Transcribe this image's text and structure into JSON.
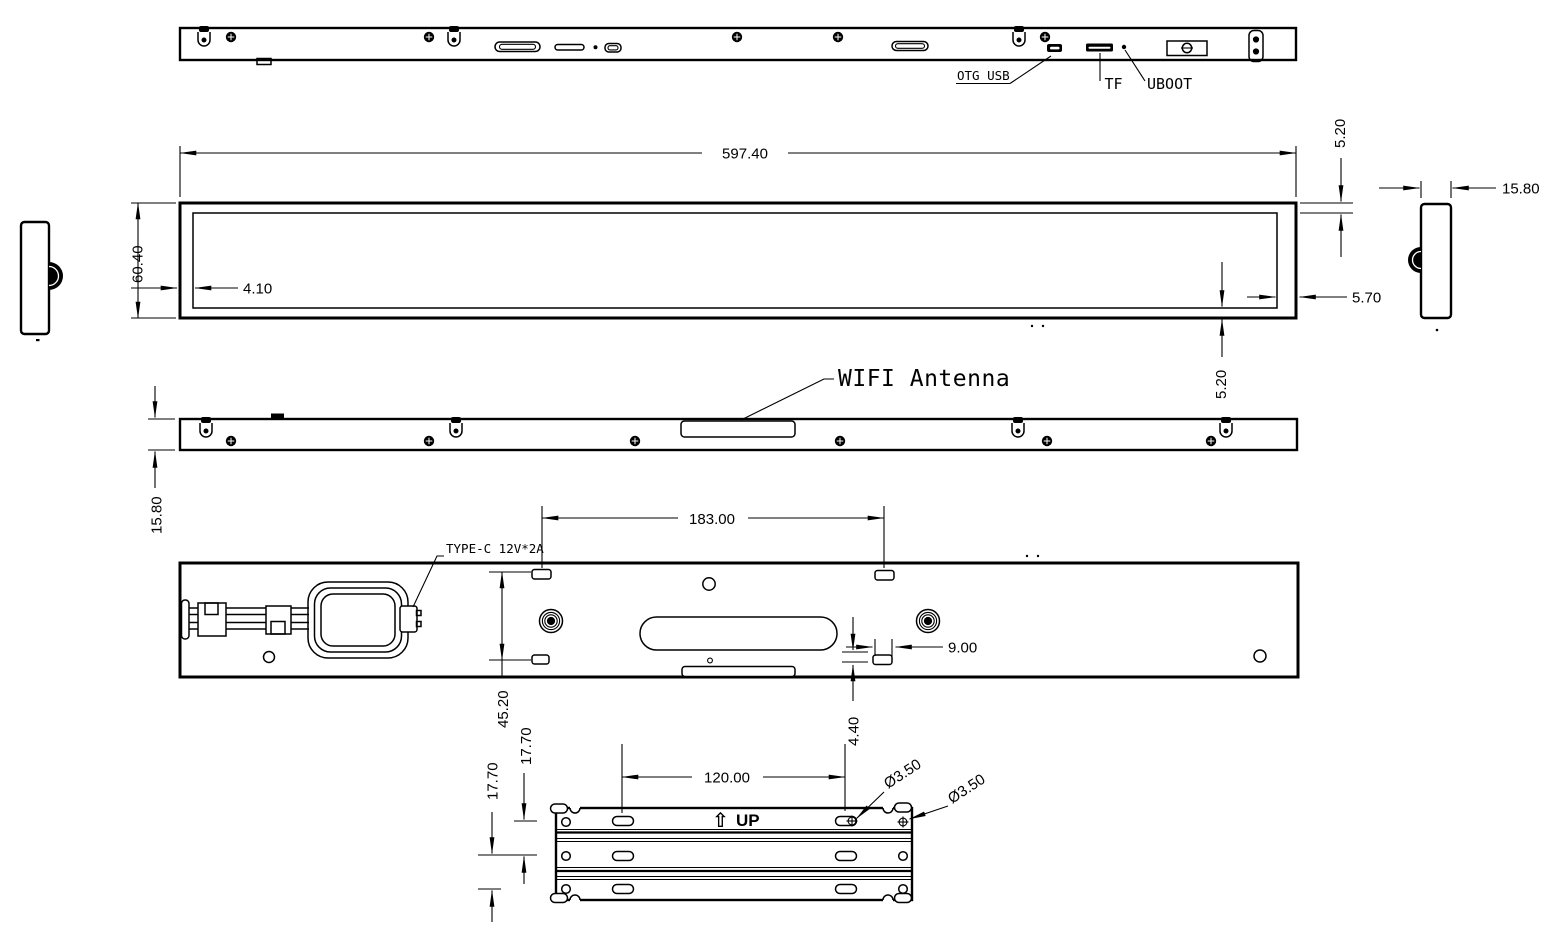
{
  "colors": {
    "ink": "#000000",
    "paper": "#ffffff"
  },
  "views": {
    "top": {
      "labels": {
        "otg_usb": "OTG USB",
        "tf": "TF",
        "uboot": "UBOOT"
      }
    },
    "front": {
      "dims": {
        "overall_width": "597.40",
        "overall_height": "60.40",
        "bezel_left": "4.10",
        "bezel_top": "5.20",
        "bezel_right": "5.70",
        "bezel_bottom": "5.20"
      }
    },
    "side_right": {
      "dims": {
        "thickness": "15.80"
      }
    },
    "edge_bottom": {
      "label_wifi_antenna": "WIFI Antenna",
      "dims": {
        "thickness": "15.80"
      }
    },
    "back": {
      "label_type_c": "TYPE-C 12V*2A",
      "dims": {
        "mount_slot_spacing": "183.00",
        "mount_height": "45.20",
        "slot_inset": "9.00",
        "tab_offset": "4.40"
      }
    },
    "bracket": {
      "label_up": "UP",
      "icons": {
        "up_arrow": "⇧"
      },
      "dims": {
        "hole_spacing": "120.00",
        "row_pitch_upper": "17.70",
        "row_pitch_lower": "17.70",
        "hole_diameter_1": "Ø3.50",
        "hole_diameter_2": "Ø3.50"
      }
    }
  }
}
